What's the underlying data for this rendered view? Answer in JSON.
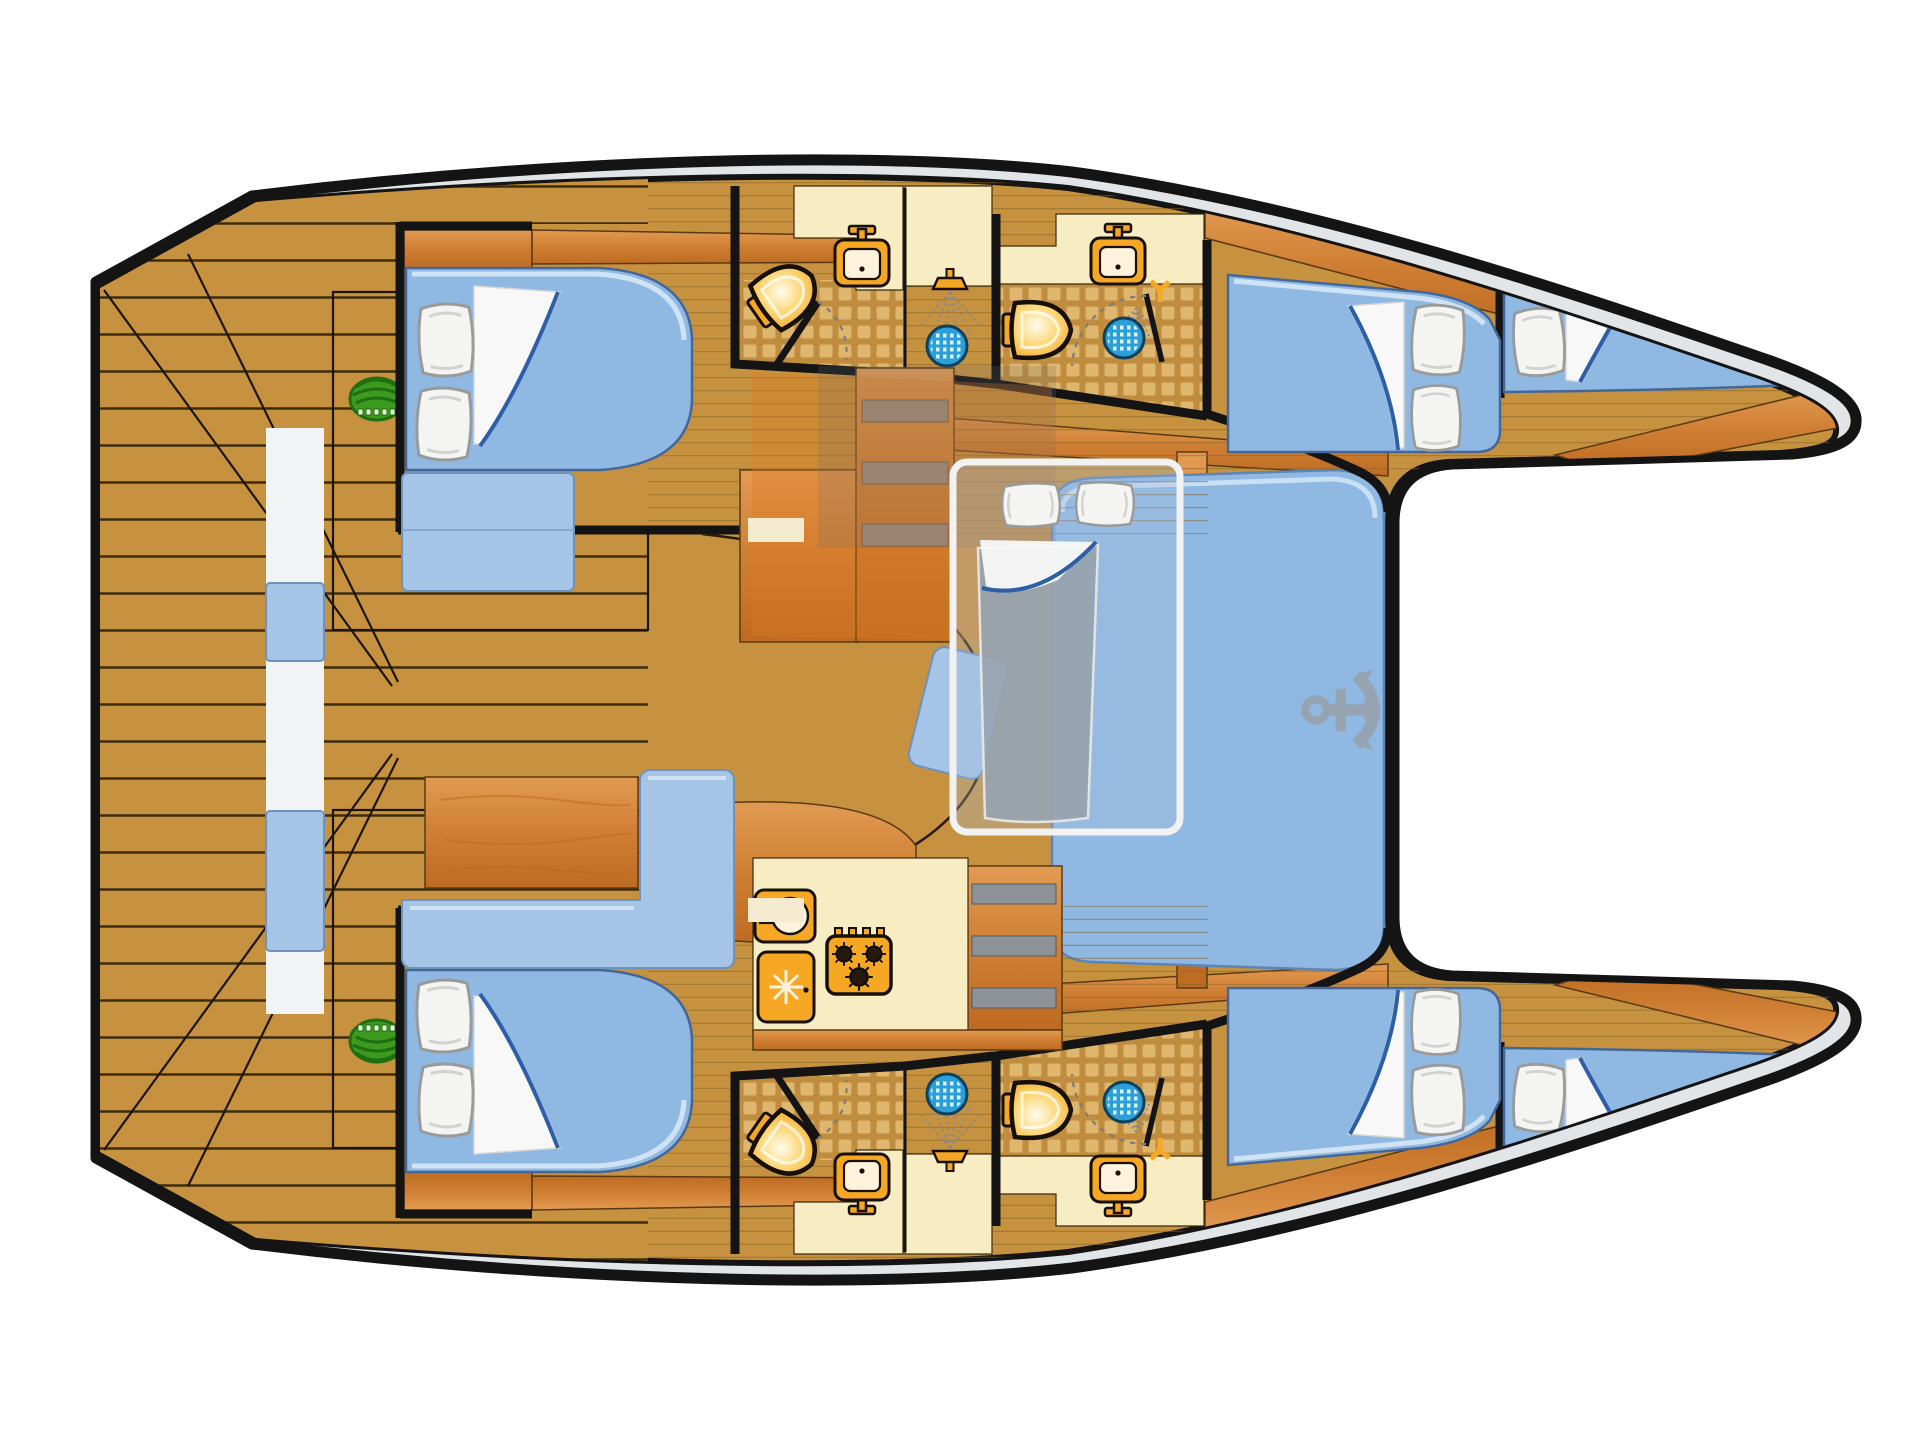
{
  "plan": {
    "type": "catamaran-yacht-floor-plan",
    "inventory": {
      "double_bed_cabins": 4,
      "bow_berths": 2,
      "bathrooms": 4,
      "toilets": 4,
      "bathroom_sinks": 4,
      "shower_drains": 4,
      "galley": {
        "stove_burners": 3,
        "fridge": 1,
        "sink": 1
      },
      "salon_convertible_berth": 1,
      "forward_lounge_anchor_mark": 1,
      "cockpit_table": 1,
      "deck_grills": 2
    },
    "colors": {
      "outline": "#141414",
      "gunwale": "#e2e5e8",
      "deck": "#c6923f",
      "plank": "#241903",
      "floorLine": "#8a6426",
      "wood": "#cf7f33",
      "woodLight": "#e29a52",
      "woodDark": "#b9671f",
      "woodEdge": "#5a3a12",
      "cream": "#f8ecc2",
      "tileBase": "#c08c3e",
      "tileSq": "#dfb870",
      "mattress": "#8fb9e3",
      "mattEdge": "#cfe3f5",
      "mattStroke": "#44679a",
      "bench": "#a5c4e6",
      "benchEdge": "#6d93bd",
      "lounge": "#8fb9e3",
      "pillow": "#f4f4f2",
      "pillowStroke": "#9a9a98",
      "sheet": "#f8f8f8",
      "sheetLine": "#2d5fa8",
      "orange": "#f6a824",
      "fixtureDark": "#161008",
      "drain": "#2a9fd8",
      "drainDot": "#d9f2fc",
      "spray": "#8a8a8a",
      "green": "#3c9a1f",
      "greenDark": "#1f6e12",
      "anchor": "#98a1a9",
      "overlayOrange": "#e07820",
      "overlayGray": "#6b6f73",
      "grayMattress": "#98a4b0",
      "stepBar": "#8d9298",
      "walkway": "#f2f3f4",
      "white": "#ffffff"
    }
  }
}
